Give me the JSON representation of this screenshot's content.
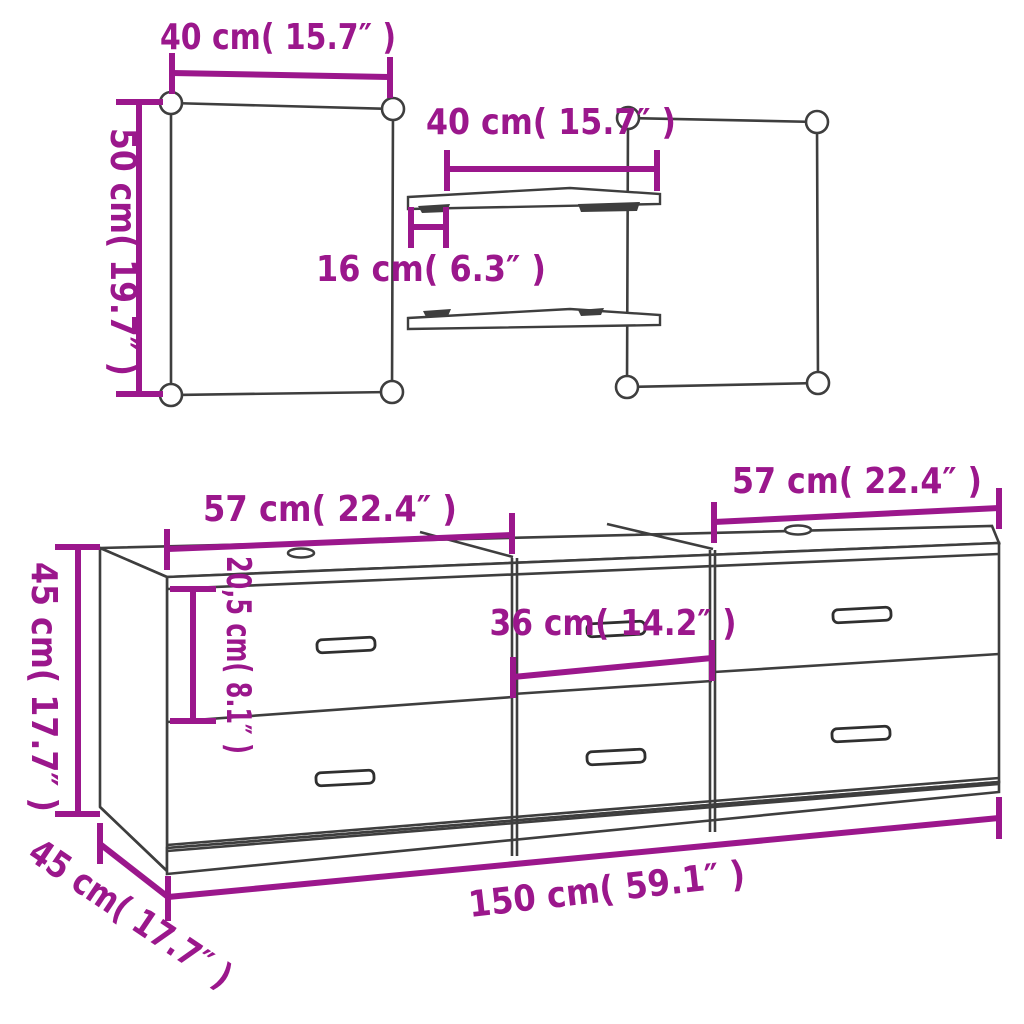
{
  "diagram_title": "Furniture set dimension diagram",
  "colors": {
    "dimension": "#9B178C",
    "outline": "#3E3E3E",
    "background": "#FFFFFF"
  },
  "top_section": {
    "left_panel": {
      "width_label": "40 cm( 15.7″ )",
      "height_label": "50 cm( 19.7″ )"
    },
    "shelves": {
      "width_label": "40 cm( 15.7″ )",
      "depth_label": "16 cm( 6.3″ )"
    }
  },
  "cabinet_section": {
    "left_unit_width_label": "57 cm( 22.4″ )",
    "right_unit_width_label": "57 cm( 22.4″ )",
    "height_label": "45 cm( 17.7″ )",
    "drawer_height_label": "20,5 cm( 8.1″ )",
    "drawer_inner_width_label": "36 cm( 14.2″ )",
    "total_width_label": "150 cm( 59.1″ )",
    "depth_label": "45 cm( 17.7″ )"
  }
}
